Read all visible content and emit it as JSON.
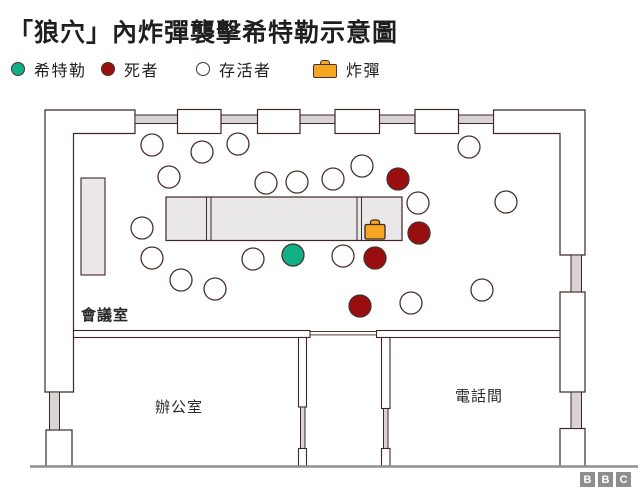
{
  "title": "「狼穴」內炸彈襲擊希特勒示意圖",
  "legend": [
    {
      "swatch": "hitler",
      "label": "希特勒"
    },
    {
      "swatch": "dead",
      "label": "死者"
    },
    {
      "swatch": "survivor",
      "label": "存活者"
    },
    {
      "swatch": "bomb",
      "label": "炸彈"
    }
  ],
  "rooms": [
    {
      "name": "conference-room",
      "label": "會議室",
      "x": 81,
      "y": 304
    },
    {
      "name": "office",
      "label": "辦公室",
      "x": 155,
      "y": 396
    },
    {
      "name": "phone-room",
      "label": "電話間",
      "x": 455,
      "y": 385
    }
  ],
  "footer": {
    "letters": [
      "B",
      "B",
      "C"
    ]
  },
  "colors": {
    "white": "#ffffff",
    "wall": "#3f2727",
    "circleStroke": "#4a3030",
    "grey": "#d8d4d4",
    "table": "#e9e7e7",
    "line": "#8f8f8f",
    "green": "#0fb184",
    "red": "#990f0f",
    "orange": "#f5a623"
  },
  "diagram": {
    "shapes": [
      {
        "t": "poly",
        "n": "wall-left",
        "pts": "45,110 135,110 135,133.5 73.5,133.5 73.5,392 45,392",
        "f": "white",
        "s": "wall",
        "sw": 1.2
      },
      {
        "t": "poly",
        "n": "wall-right",
        "pts": "493.5,110 585,110 585,255 560,255 560,133.5 493.5,133.5",
        "f": "white",
        "s": "wall",
        "sw": 1.2
      },
      {
        "t": "rect",
        "n": "wall-left-bottom",
        "x": 46,
        "y": 430,
        "w": 26,
        "h": 36,
        "f": "white",
        "s": "wall",
        "sw": 1.2
      },
      {
        "t": "rect",
        "n": "wall-right-mid",
        "x": 560,
        "y": 292,
        "w": 25,
        "h": 100,
        "f": "white",
        "s": "wall",
        "sw": 1.2
      },
      {
        "t": "rect",
        "n": "wall-right-bottom",
        "x": 560,
        "y": 428.5,
        "w": 25,
        "h": 38,
        "f": "white",
        "s": "wall",
        "sw": 1.2
      },
      {
        "t": "rect",
        "n": "radiator",
        "x": 49.5,
        "y": 392,
        "w": 10,
        "h": 38,
        "f": "grey",
        "s": "wall",
        "sw": 1
      },
      {
        "t": "rect",
        "n": "radiator",
        "x": 571,
        "y": 255,
        "w": 10.5,
        "h": 37,
        "f": "grey",
        "s": "wall",
        "sw": 1
      },
      {
        "t": "rect",
        "n": "radiator",
        "x": 571,
        "y": 392,
        "w": 10.5,
        "h": 36.5,
        "f": "grey",
        "s": "wall",
        "sw": 1
      },
      {
        "t": "rect",
        "n": "window-band",
        "x": 135,
        "y": 115,
        "w": 42.5,
        "h": 8.5,
        "f": "grey",
        "s": "wall",
        "sw": 1
      },
      {
        "t": "rect",
        "n": "window-band",
        "x": 221,
        "y": 115,
        "w": 36.5,
        "h": 8.5,
        "f": "grey",
        "s": "wall",
        "sw": 1
      },
      {
        "t": "rect",
        "n": "window-band",
        "x": 300,
        "y": 115,
        "w": 35,
        "h": 8.5,
        "f": "grey",
        "s": "wall",
        "sw": 1
      },
      {
        "t": "rect",
        "n": "window-band",
        "x": 379.5,
        "y": 115,
        "w": 35.5,
        "h": 8.5,
        "f": "grey",
        "s": "wall",
        "sw": 1
      },
      {
        "t": "rect",
        "n": "window-band",
        "x": 458.5,
        "y": 115,
        "w": 35,
        "h": 8.5,
        "f": "grey",
        "s": "wall",
        "sw": 1
      },
      {
        "t": "rect",
        "n": "window",
        "x": 177.5,
        "y": 109.5,
        "w": 43.5,
        "h": 24,
        "f": "white",
        "s": "wall",
        "sw": 1.2
      },
      {
        "t": "rect",
        "n": "window",
        "x": 257.5,
        "y": 109.5,
        "w": 42.5,
        "h": 24,
        "f": "white",
        "s": "wall",
        "sw": 1.2
      },
      {
        "t": "rect",
        "n": "window",
        "x": 335,
        "y": 109.5,
        "w": 44.5,
        "h": 24,
        "f": "white",
        "s": "wall",
        "sw": 1.2
      },
      {
        "t": "rect",
        "n": "window",
        "x": 415,
        "y": 109.5,
        "w": 43.5,
        "h": 24,
        "f": "white",
        "s": "wall",
        "sw": 1.2
      },
      {
        "t": "rect",
        "n": "interior-wall",
        "x": 73.5,
        "y": 330.5,
        "w": 236.5,
        "h": 7,
        "f": "white",
        "s": "wall",
        "sw": 1.1
      },
      {
        "t": "rect",
        "n": "interior-wall",
        "x": 376.5,
        "y": 330.5,
        "w": 183.5,
        "h": 7,
        "f": "white",
        "s": "wall",
        "sw": 1.1
      },
      {
        "t": "rect",
        "n": "door-passage",
        "x": 310,
        "y": 331.5,
        "w": 66.5,
        "h": 3.4,
        "f": "white",
        "s": "wall",
        "sw": 0.9
      },
      {
        "t": "rect",
        "n": "interior-wall",
        "x": 298.5,
        "y": 337.5,
        "w": 8,
        "h": 69.5,
        "f": "white",
        "s": "wall",
        "sw": 1.1
      },
      {
        "t": "rect",
        "n": "radiator",
        "x": 300.5,
        "y": 407,
        "w": 4.5,
        "h": 41.5,
        "f": "grey",
        "s": "wall",
        "sw": 1
      },
      {
        "t": "rect",
        "n": "interior-wall",
        "x": 298.5,
        "y": 448.5,
        "w": 8,
        "h": 17.5,
        "f": "white",
        "s": "wall",
        "sw": 1.1
      },
      {
        "t": "rect",
        "n": "interior-wall",
        "x": 381.5,
        "y": 337.5,
        "w": 8.5,
        "h": 71,
        "f": "white",
        "s": "wall",
        "sw": 1.1
      },
      {
        "t": "rect",
        "n": "radiator",
        "x": 383.5,
        "y": 408.5,
        "w": 4.5,
        "h": 40,
        "f": "grey",
        "s": "wall",
        "sw": 1
      },
      {
        "t": "rect",
        "n": "interior-wall",
        "x": 381.5,
        "y": 448.5,
        "w": 8.5,
        "h": 17.5,
        "f": "white",
        "s": "wall",
        "sw": 1.1
      },
      {
        "t": "line",
        "n": "south-wall",
        "x1": 30,
        "y1": 466.5,
        "x2": 638,
        "y2": 466.5,
        "s": "line",
        "sw": 2.4
      },
      {
        "t": "rect",
        "n": "sideboard",
        "x": 81,
        "y": 178,
        "w": 24,
        "h": 97,
        "f": "table",
        "s": "wall",
        "sw": 1.1
      },
      {
        "t": "rect",
        "n": "map-table",
        "x": 166,
        "y": 197,
        "w": 236,
        "h": 43.5,
        "f": "table",
        "s": "wall",
        "sw": 1.2
      },
      {
        "t": "line",
        "n": "table-divider",
        "x1": 206.5,
        "y1": 197,
        "x2": 206.5,
        "y2": 240.5,
        "s": "wall",
        "sw": 1
      },
      {
        "t": "line",
        "n": "table-divider",
        "x1": 211,
        "y1": 197,
        "x2": 211,
        "y2": 240.5,
        "s": "wall",
        "sw": 1
      },
      {
        "t": "line",
        "n": "table-divider",
        "x1": 357,
        "y1": 197,
        "x2": 357,
        "y2": 240.5,
        "s": "wall",
        "sw": 1
      },
      {
        "t": "line",
        "n": "table-divider",
        "x1": 361.5,
        "y1": 197,
        "x2": 361.5,
        "y2": 240.5,
        "s": "wall",
        "sw": 1
      }
    ],
    "people": {
      "radius": 11,
      "strokeWidth": 1.3,
      "survivors": [
        [
          152,
          145
        ],
        [
          202,
          152
        ],
        [
          238,
          144
        ],
        [
          169,
          177
        ],
        [
          266,
          183
        ],
        [
          297,
          182
        ],
        [
          333,
          179
        ],
        [
          362,
          166
        ],
        [
          142,
          228
        ],
        [
          152,
          258
        ],
        [
          181,
          280
        ],
        [
          215,
          289
        ],
        [
          253,
          259
        ],
        [
          343,
          256
        ],
        [
          418,
          203
        ],
        [
          469,
          147
        ],
        [
          506,
          202
        ],
        [
          482,
          290
        ],
        [
          411,
          303
        ]
      ],
      "dead": [
        [
          398,
          179
        ],
        [
          419,
          233
        ],
        [
          375,
          258
        ],
        [
          360,
          306
        ]
      ],
      "hitler": [
        293,
        255
      ]
    },
    "bomb": {
      "x": 365,
      "y": 224.5,
      "w": 20,
      "h": 14.5,
      "hx": 370.5,
      "hy": 220,
      "hw": 9,
      "hh": 6
    }
  }
}
